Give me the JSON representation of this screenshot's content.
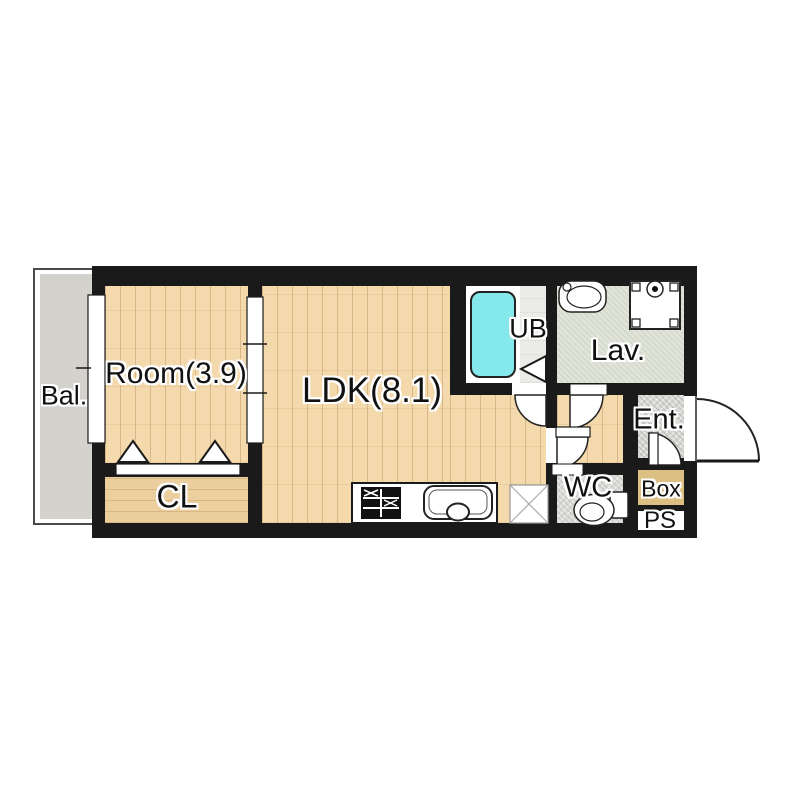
{
  "floorplan": {
    "rooms": [
      {
        "id": "bal",
        "label": "Bal."
      },
      {
        "id": "room",
        "label": "Room(3.9)"
      },
      {
        "id": "cl",
        "label": "CL"
      },
      {
        "id": "ldk",
        "label": "LDK(8.1)"
      },
      {
        "id": "ub",
        "label": "UB"
      },
      {
        "id": "lav",
        "label": "Lav."
      },
      {
        "id": "ent",
        "label": "Ent."
      },
      {
        "id": "wc",
        "label": "WC"
      },
      {
        "id": "box",
        "label": "Box"
      },
      {
        "id": "ps",
        "label": "PS"
      }
    ],
    "fixtures": [
      "bathtub-icon",
      "washbasin-icon",
      "washing-machine-icon",
      "toilet-icon",
      "stove-icon",
      "kitchen-sink-icon",
      "refrigerator-space-icon",
      "window",
      "sliding-door",
      "closet-folding-doors",
      "bath-folding-door",
      "door-swing-arcs",
      "entrance-door-arc"
    ],
    "colors": {
      "wall": "#1a1a1a",
      "wood": "#f3d9ac",
      "wood_cl": "#eccf9e",
      "balcony": "#d3d2cd",
      "ub": "#ebece8",
      "lav": "#e0e4d8",
      "ent": "#d8d8d4",
      "wc": "#dbdbd7",
      "box": "#dcc083",
      "tub": "#85e8ec"
    }
  }
}
